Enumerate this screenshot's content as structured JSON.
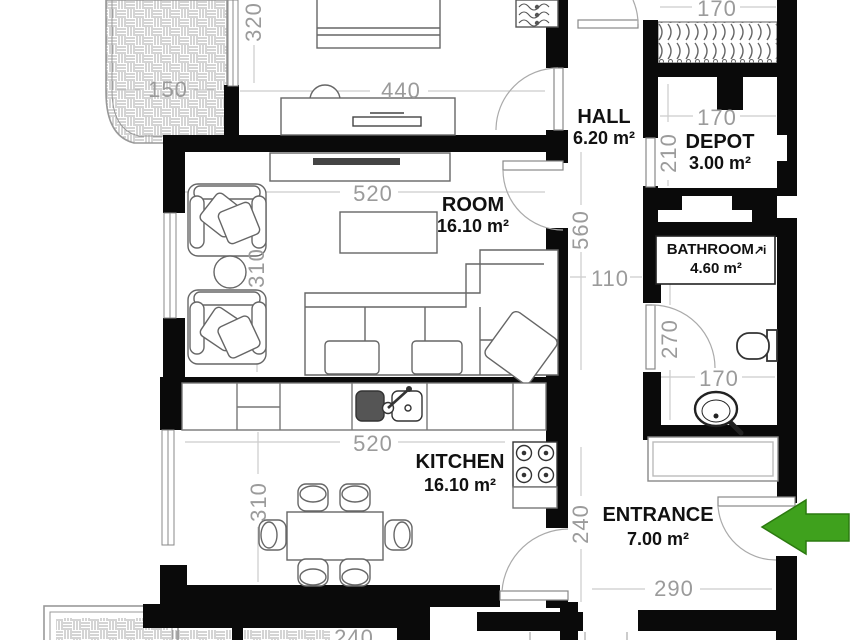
{
  "colors": {
    "wall": "#0a0a0a",
    "dimension": "#9b9b9b",
    "arrow_fill": "#3fa11d",
    "arrow_stroke": "#2c7a10"
  },
  "rooms": {
    "hall": {
      "name": "HALL",
      "area": "6.20 m²"
    },
    "depot": {
      "name": "DEPOT",
      "area": "3.00 m²"
    },
    "bathroom": {
      "name": "BATHROOM",
      "area": "4.60 m²",
      "icon": "↗i"
    },
    "room": {
      "name": "ROOM",
      "area": "16.10 m²"
    },
    "kitchen": {
      "name": "KITCHEN",
      "area": "16.10 m²"
    },
    "entrance": {
      "name": "ENTRANCE",
      "area": "7.00 m²"
    }
  },
  "dimensions": {
    "terrace_width": "150",
    "bedroom_width": "440",
    "bedroom_height": "320",
    "closet_width": "170",
    "room_width": "520",
    "room_height": "310",
    "hall_length": "560",
    "corridor_width": "110",
    "depot_door": "210",
    "depot_width": "170",
    "bathroom_height": "270",
    "bathroom_width": "170",
    "kitchen_width": "520",
    "kitchen_height": "310",
    "entrance_height": "240",
    "entrance_width": "290",
    "lower_terrace": "240"
  }
}
